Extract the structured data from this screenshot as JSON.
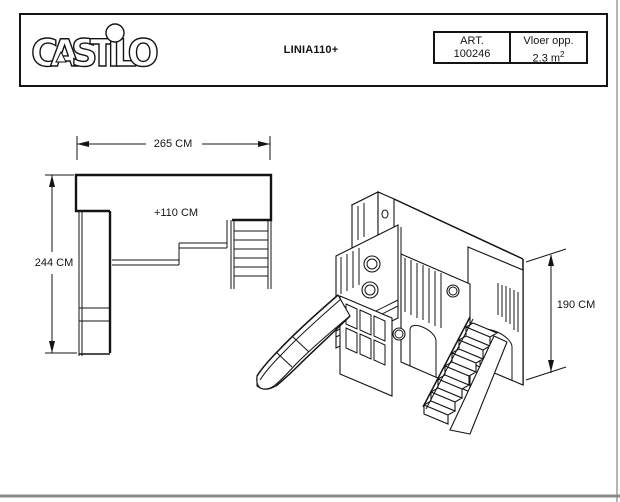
{
  "header": {
    "logo": "CASTILO",
    "product_name": "LINIA110+",
    "art": {
      "label": "ART.",
      "number": "100246"
    },
    "floor": {
      "label": "Vloer opp.",
      "value": "2.3 m",
      "sup": "2"
    }
  },
  "dimensions": {
    "plan_width": "265 CM",
    "plan_depth": "244 CM",
    "platform_height": "+110 CM",
    "iso_height": "190 CM"
  },
  "colors": {
    "line": "#141414",
    "sheet_frame": "#9a9a9a"
  }
}
